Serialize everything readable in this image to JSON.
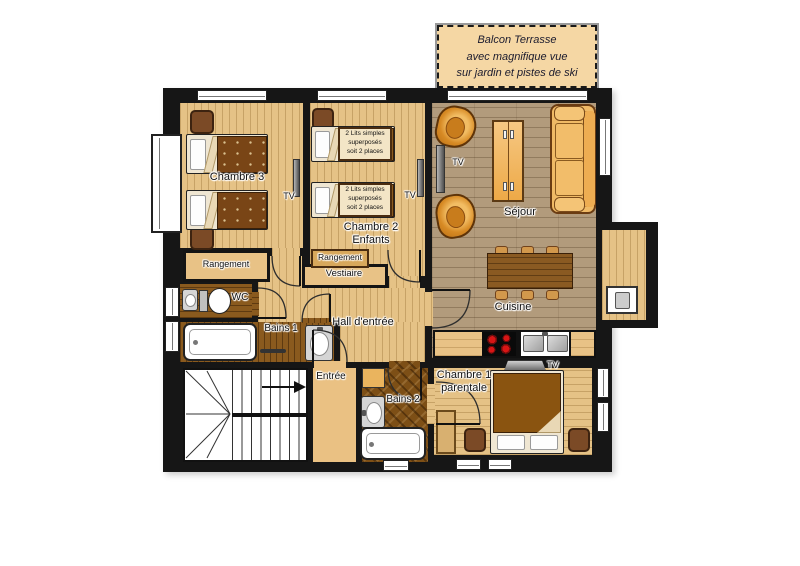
{
  "banner": {
    "lines": [
      "Balcon Terrasse",
      "avec magnifique vue",
      "sur jardin et pistes de ski"
    ]
  },
  "rooms": {
    "chambre3": "Chambre 3",
    "chambre2": [
      "Chambre 2",
      "Enfants"
    ],
    "sejour": "Séjour",
    "cuisine": "Cuisine",
    "chambre1": [
      "Chambre 1",
      "parentale"
    ],
    "hall": "Hall d'entrée",
    "entree": "Entrée",
    "bains1": "Bains 1",
    "bains2": "Bains 2",
    "wc": "WC",
    "vestiaire": "Vestiaire",
    "rangement": "Rangement"
  },
  "labels": {
    "tv": "TV",
    "bunk": [
      "2 Lits simples",
      "superposés",
      "soit 2 places"
    ]
  },
  "colors": {
    "wall": "#161616",
    "floor_bedroom": "#e5c286",
    "floor_living": "#b29b7c",
    "floor_bath": "#8a5a1e",
    "banner_bg": "#f5d7a4",
    "accent_orange": "#e0952f",
    "blanket_brown": "#794516"
  }
}
